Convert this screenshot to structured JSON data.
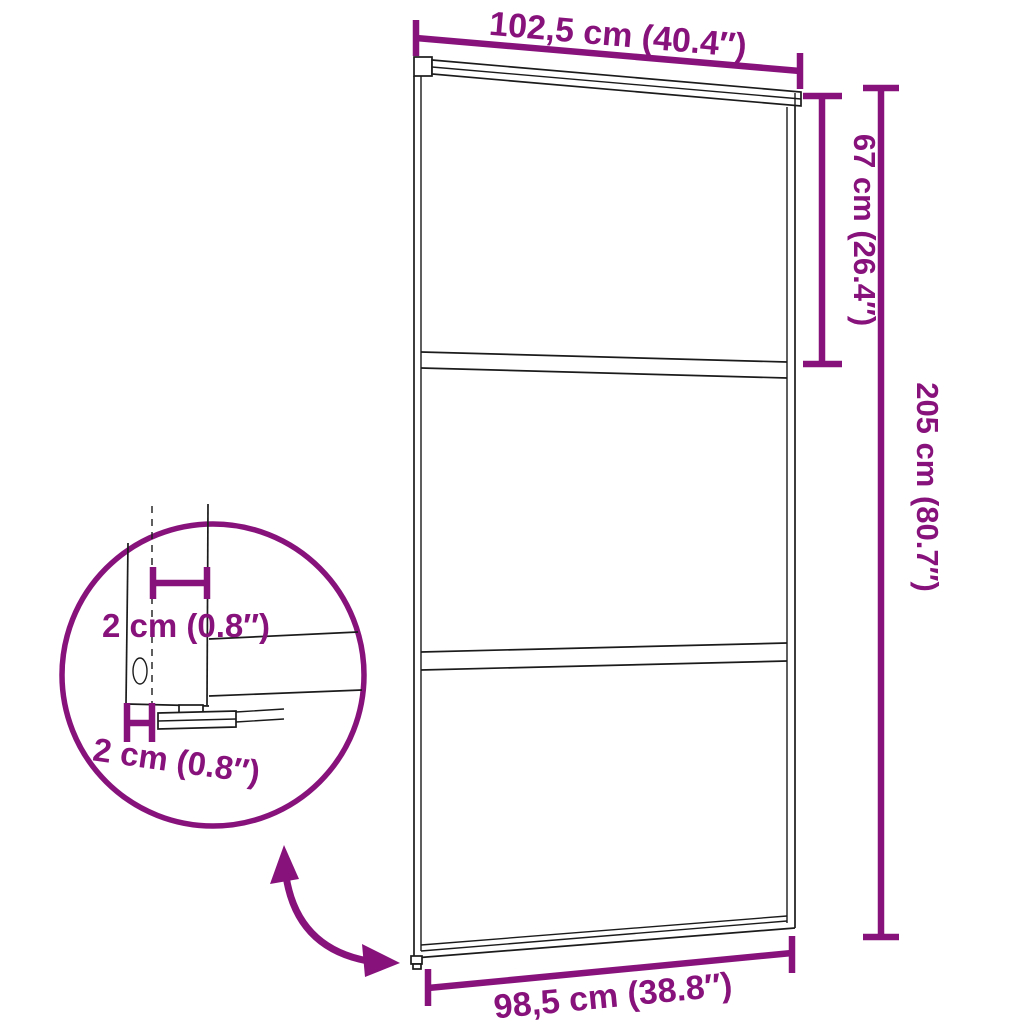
{
  "diagram": {
    "type": "product-dimension-diagram",
    "subject": "sliding-glass-door",
    "colors": {
      "accent": "#87127C",
      "line": "#1B1B1B",
      "bg": "#FFFFFF"
    },
    "dimensions": {
      "top_width": "102,5 cm (40.4″)",
      "upper_section_height": "67 cm (26.4″)",
      "total_height": "205 cm (80.7″)",
      "bottom_width": "98,5 cm (38.8″)",
      "detail_profile_width": "2 cm (0.8″)",
      "detail_profile_depth": "2 cm (0.8″)"
    },
    "icons": {
      "detail_circle": "magnifier-detail-circle",
      "slide_arrow": "curved-double-arrow"
    }
  }
}
